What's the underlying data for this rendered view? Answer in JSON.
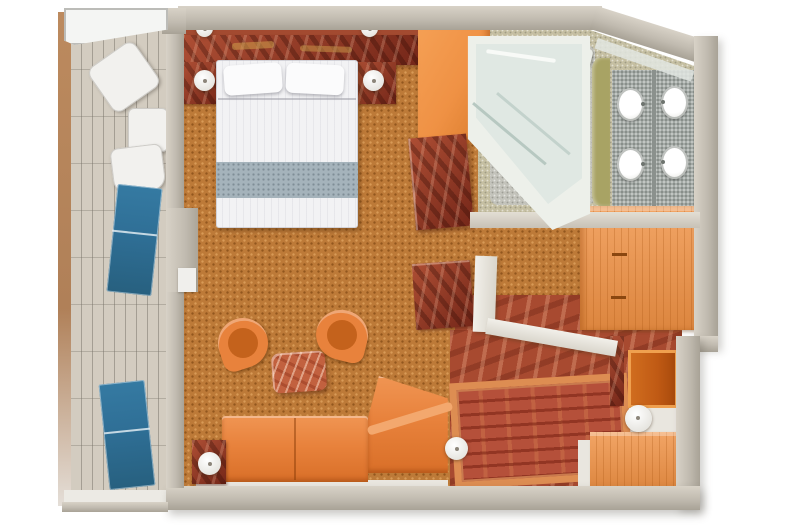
{
  "floorplan": {
    "kind": "cruise-ship-grand-suite-3d-top-view",
    "rooms": [
      {
        "name": "balcony",
        "furniture": [
          "white-lounge-chair",
          "white-lounge-chair",
          "white-side-table",
          "blue-sun-lounger",
          "blue-sun-lounger",
          "glass-partition"
        ]
      },
      {
        "name": "bedroom",
        "furniture": [
          "king-bed",
          "pillow",
          "pillow",
          "marble-headboard-console",
          "nightstand-left",
          "nightstand-right",
          "table-lamp",
          "table-lamp",
          "wall-sconce",
          "wall-sconce",
          "tall-orange-cabinet",
          "marble-dresser"
        ]
      },
      {
        "name": "living-area",
        "furniture": [
          "tub-chair",
          "tub-chair",
          "marble-coffee-table",
          "orange-sectional-sofa",
          "chaise-section",
          "marble-side-table",
          "side-table-lamp",
          "round-ottoman"
        ]
      },
      {
        "name": "bathroom",
        "furniture": [
          "jacuzzi-whirlpool-tub",
          "toilet",
          "vanity-counter",
          "vanity-counter",
          "round-sink",
          "round-sink",
          "round-sink",
          "round-sink",
          "mirror-strip"
        ]
      },
      {
        "name": "walk-in-closet",
        "furniture": [
          "orange-wardrobe"
        ]
      },
      {
        "name": "entry-hall",
        "furniture": [
          "red-marble-floor",
          "area-rug",
          "marble-writing-desk",
          "white-partition-wall",
          "entry-door",
          "orange-cabinet",
          "white-waste-bin"
        ]
      }
    ],
    "colors": {
      "bg": "#ffffff",
      "wall": "#c1bbb0",
      "wall_light": "#d8d2c7",
      "wall_dark": "#a8a296",
      "carpet": "#bd7a38",
      "balcony_floor": "#d3ccc0",
      "balcony_rail": "#b5855c",
      "glass": "#f4f5f3",
      "marble_dark": "#8e2f1e",
      "marble_floor": "#a84a30",
      "marble_coffee": "#c2613f",
      "bed_white": "#f2f2f4",
      "bed_band": "#a5b3bb",
      "orange": "#e8823c",
      "orange_dark": "#c4621c",
      "orange_light": "#f3a86e",
      "wardrobe": "#ef9144",
      "door": "#c05a14",
      "rug_border": "#dd8d52",
      "rug_center": "#b5503a",
      "lounger_blue": "#2f6f96",
      "bath_floor": "#c5bfa2",
      "granite": "#a4aaa6",
      "khaki": "#a8a364",
      "tub": "#edf0ea",
      "tub_inner": "#e0e8e3",
      "white_furn": "#f2f1ee"
    }
  }
}
